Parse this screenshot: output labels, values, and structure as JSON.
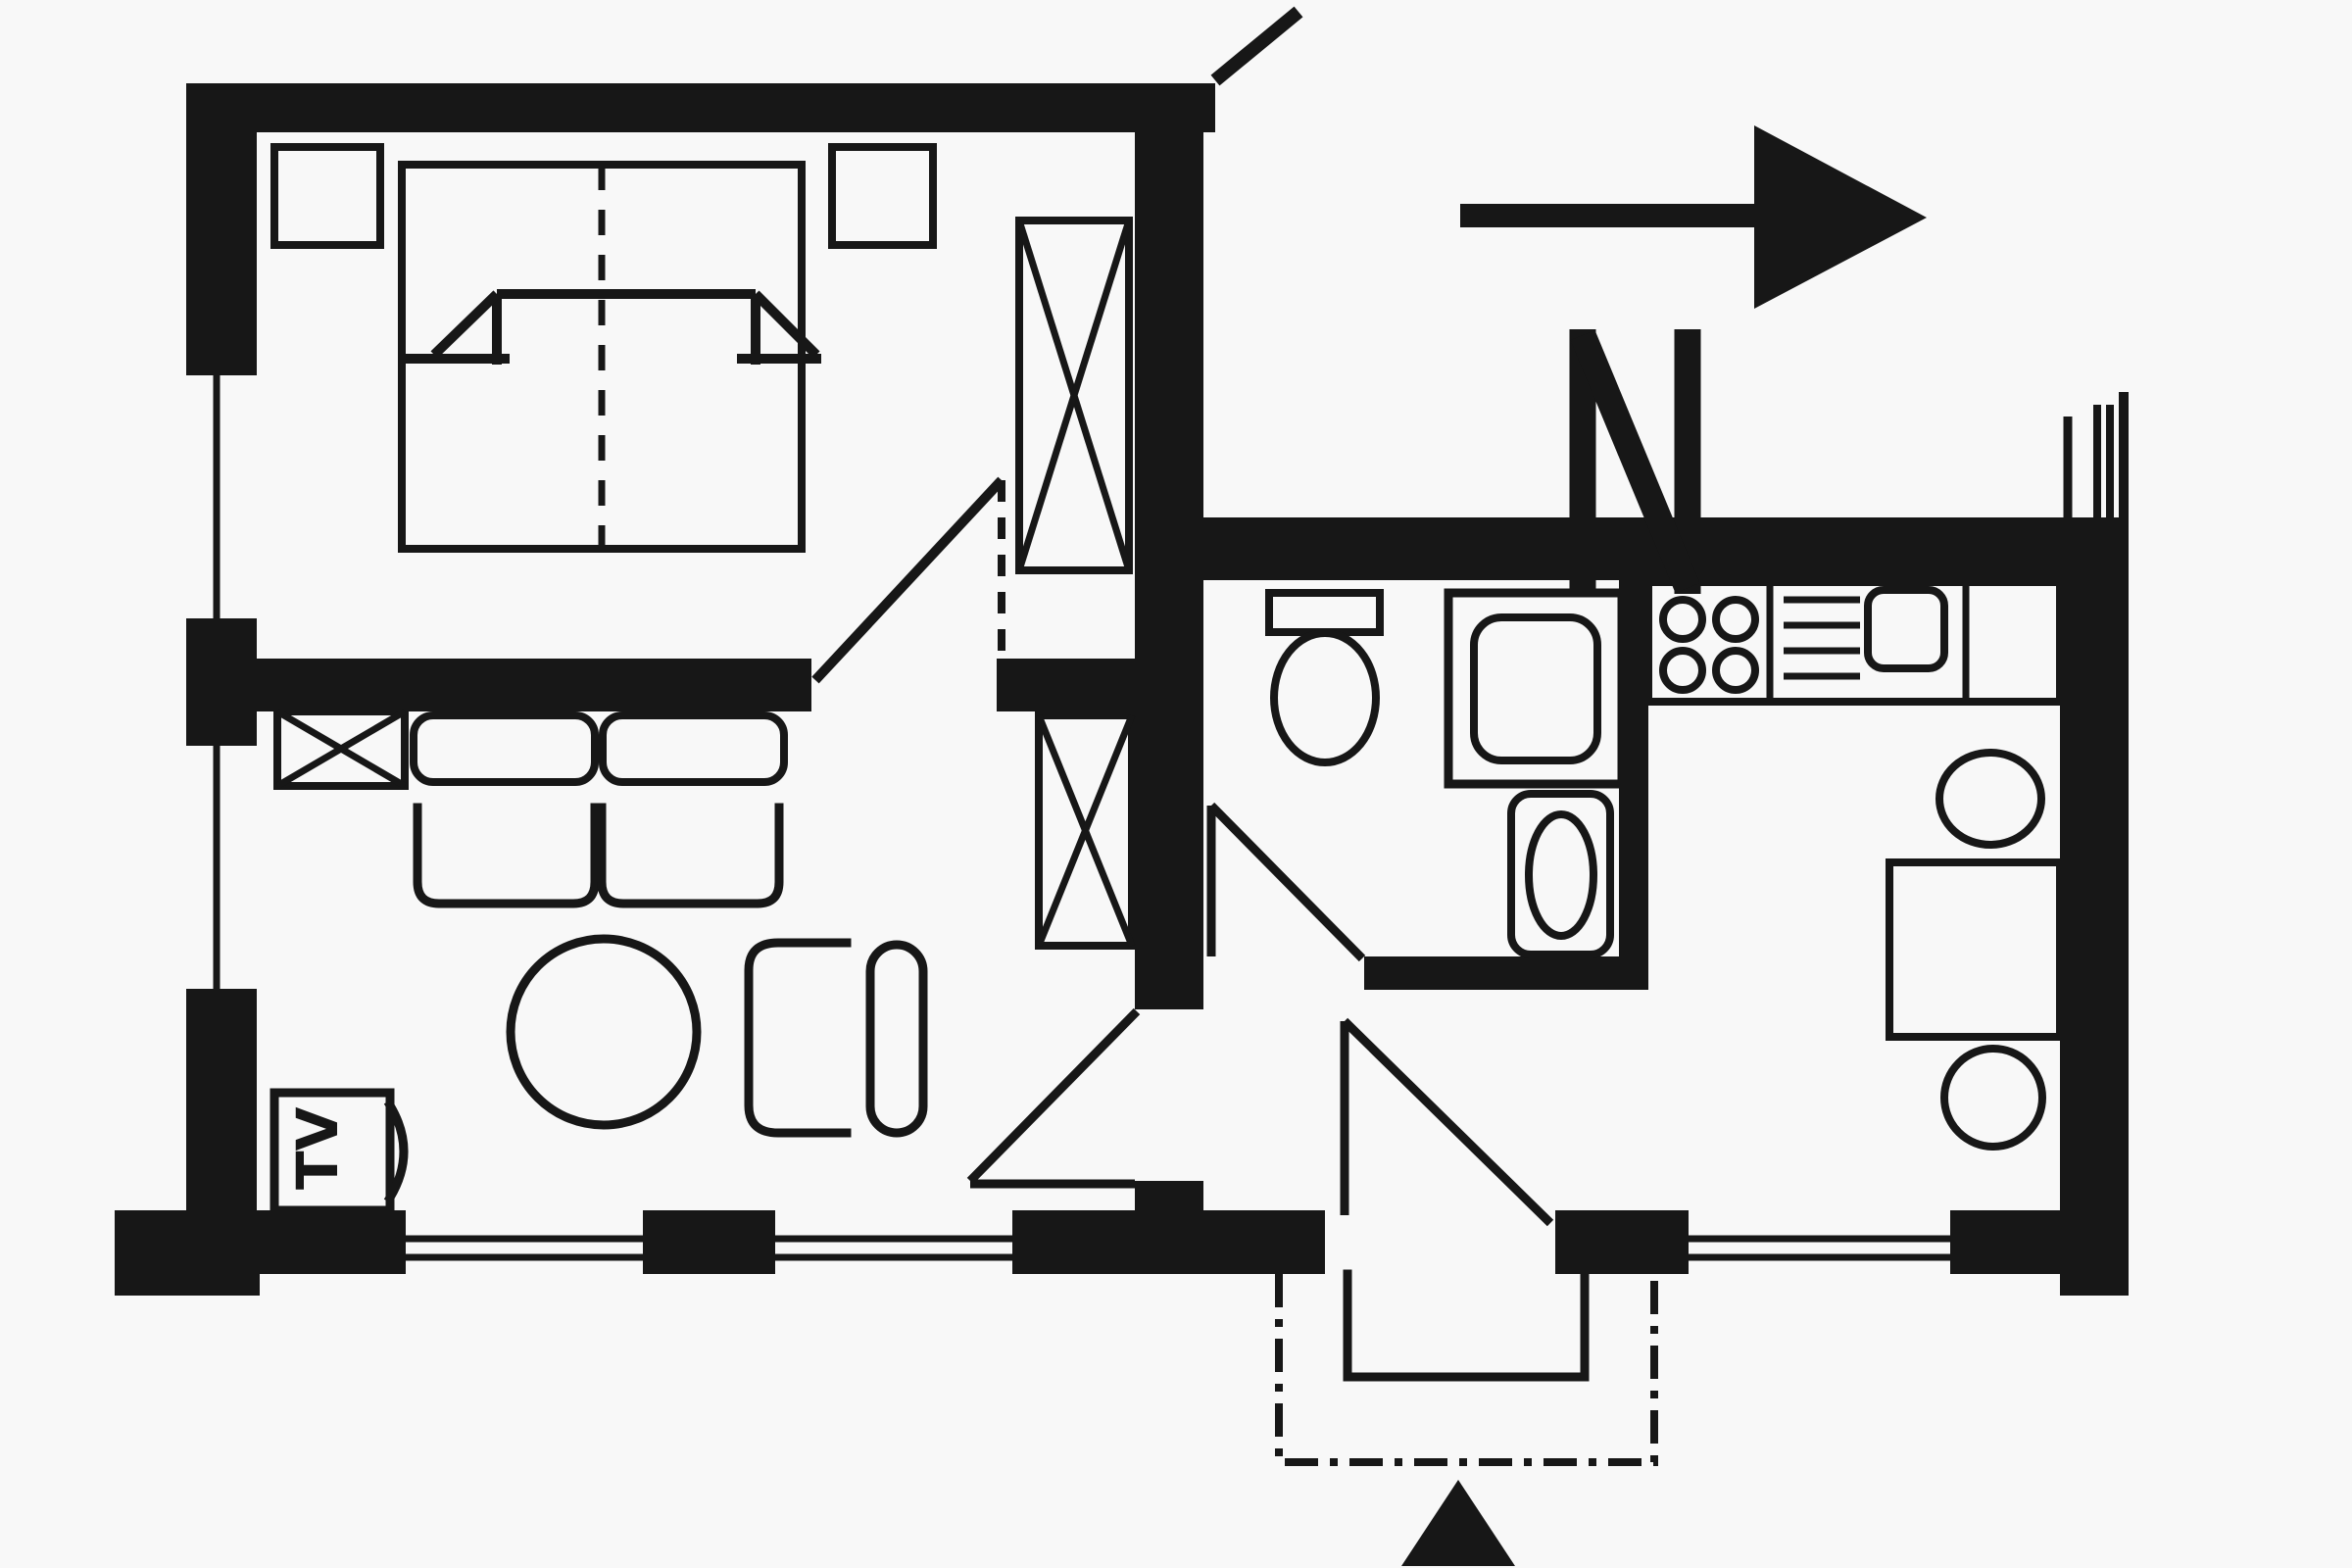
{
  "title": "apartment-floor-plan",
  "palette": {
    "ink": "#171717",
    "paper": "#f8f8f8"
  },
  "compass": {
    "label": "N",
    "direction": "north-arrow-pointing-right"
  },
  "living_room": {
    "tv_label": "TV",
    "symbols": [
      "crossed-box-cabinet",
      "two-seat-sofa",
      "two-seat-cushions",
      "round-table",
      "armchair",
      "lounge-chair",
      "tv-set",
      "crossed-box-wardrobe",
      "window-left",
      "window-bottom-1",
      "window-bottom-2",
      "door-to-hall"
    ]
  },
  "bedroom": {
    "symbols": [
      "double-bed",
      "bed-center-dashed-line",
      "blanket-fold-marks",
      "nightstand-left",
      "nightstand-right",
      "crossed-box-wardrobe",
      "window-left",
      "door-to-hall",
      "wall-break-tick"
    ]
  },
  "bathroom": {
    "symbols": [
      "toilet-with-tank",
      "shower-tray",
      "wash-basin",
      "door-to-hall"
    ]
  },
  "kitchen": {
    "symbols": [
      "counter",
      "stove-four-burners",
      "sink-with-drainboard",
      "sink-basin",
      "dining-table",
      "chair-top",
      "chair-bottom",
      "window-bottom",
      "continuation-hatch-marks"
    ]
  },
  "hall": {
    "symbols": [
      "entrance-door-swing",
      "living-room-door-swing",
      "bathroom-door-swing"
    ]
  },
  "entrance": {
    "symbols": [
      "door-opening",
      "outside-step-solid-outline",
      "porch-dash-dot-outline",
      "entry-arrow-triangle"
    ]
  }
}
